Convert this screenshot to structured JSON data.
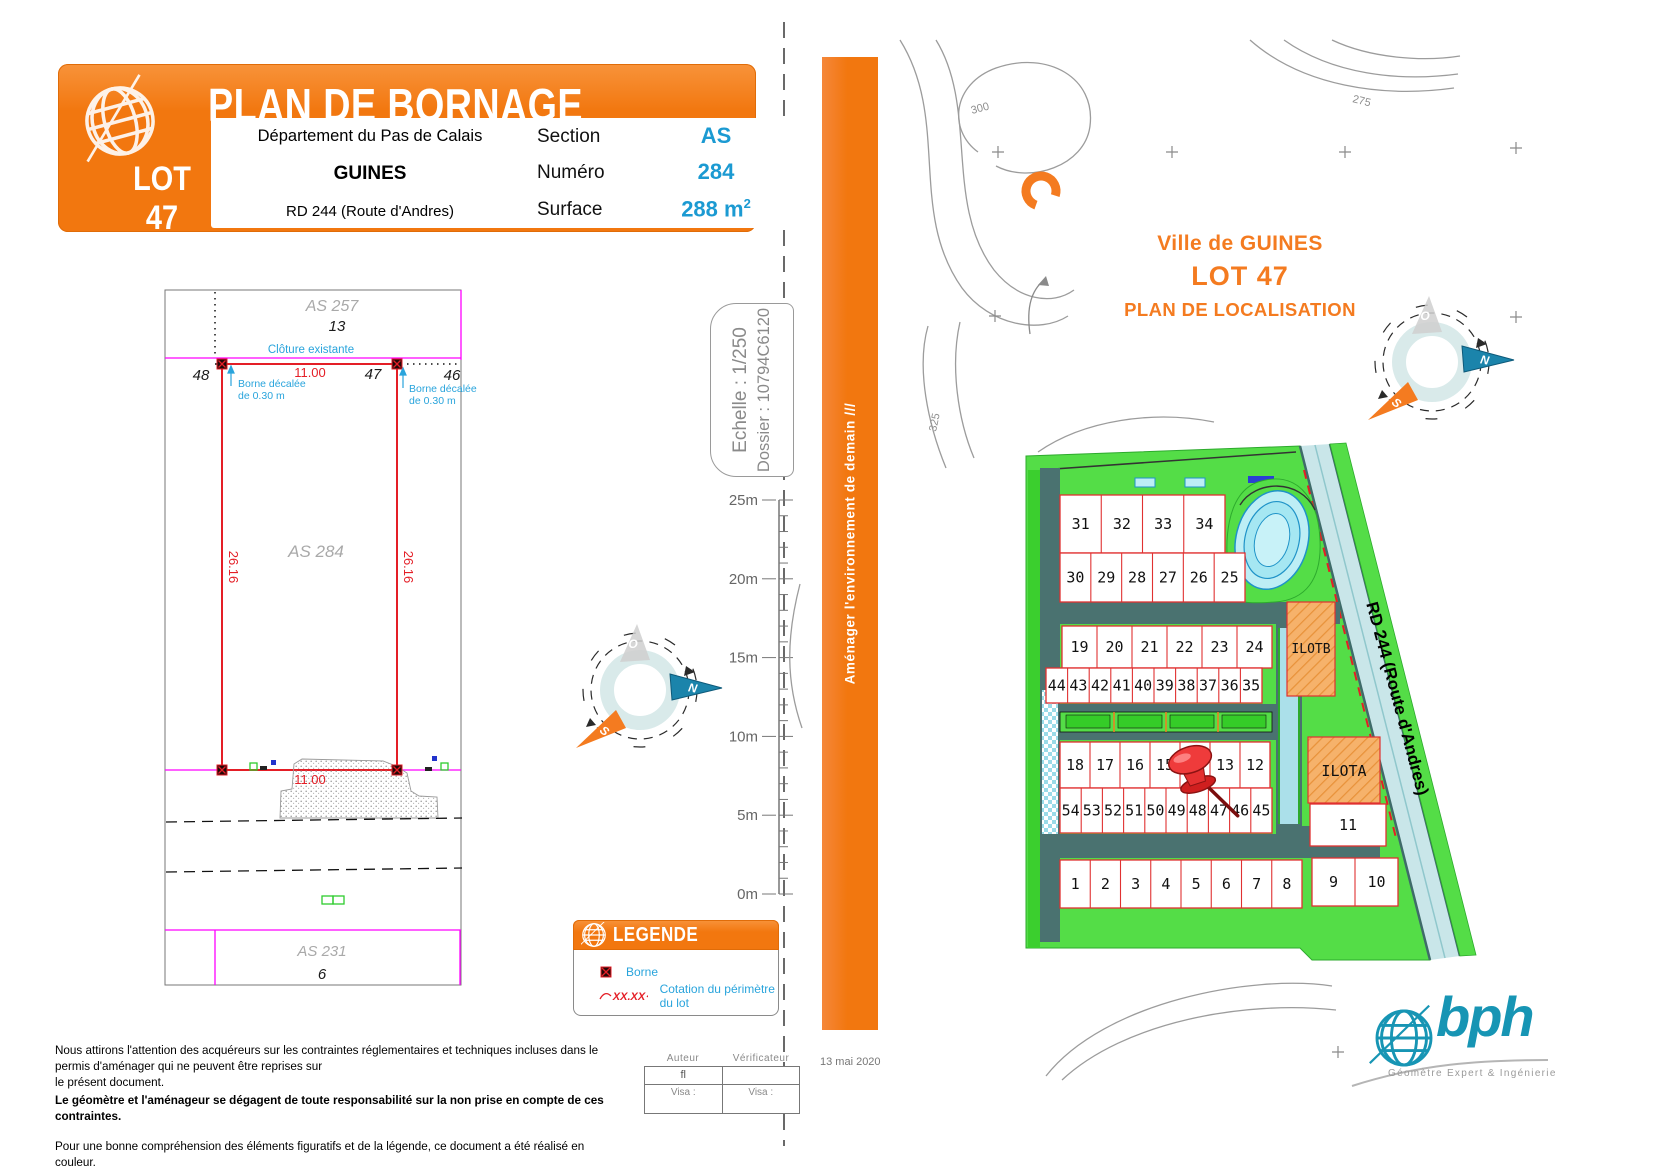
{
  "header": {
    "title": "PLAN DE BORNAGE",
    "lot": "LOT 47",
    "departement": "Département du Pas de Calais",
    "commune": "GUINES",
    "road": "RD 244 (Route d'Andres)",
    "fields": [
      {
        "label": "Section",
        "value": "AS"
      },
      {
        "label": "Numéro",
        "value": "284"
      },
      {
        "label": "Surface",
        "value": "288 m",
        "sup": "2"
      }
    ]
  },
  "survey": {
    "parcel_top": "AS 257",
    "parcel_top_num": "13",
    "cloture": "Clôture existante",
    "dim_top": "11.00",
    "pt_left": "48",
    "pt_mid": "47",
    "pt_right": "46",
    "note_l1": "Borne décalée",
    "note_l2": "de 0.30 m",
    "dim_left": "26.16",
    "dim_right": "26.16",
    "parcel_main": "AS 284",
    "dim_bottom": "11.00",
    "parcel_bottom": "AS 231",
    "parcel_bottom_num": "6"
  },
  "scalebox": {
    "echelle": "Echelle : 1/250",
    "dossier": "Dossier : 10794C6120"
  },
  "ruler": {
    "labels": [
      "25m",
      "20m",
      "15m",
      "10m",
      "5m",
      "0m"
    ]
  },
  "legend": {
    "title": "LEGENDE",
    "borne_label": "Borne",
    "cotation_sample": "XX.XX",
    "cotation_label": "Cotation du périmètre du lot"
  },
  "notes": {
    "l1": "Nous attirons l'attention des acquéreurs sur les contraintes réglementaires et techniques incluses dans le permis d'aménager qui ne peuvent être reprises sur",
    "l2": "le présent document.",
    "l3": "Le géomètre et l'aménageur se dégagent de toute responsabilité sur la non prise en compte de ces contraintes.",
    "l4": "Pour une bonne compréhension des éléments figuratifs et de la légende, ce document a été réalisé en couleur."
  },
  "approval": {
    "author_header": "Auteur",
    "verifier_header": "Vérificateur",
    "author": "fl",
    "visa_left": "Visa :",
    "visa_right": "Visa :"
  },
  "banner": {
    "slogan": "Aménager l'environnement de demain ///",
    "date": "13 mai 2020"
  },
  "loc": {
    "line1": "Ville de GUINES",
    "line2": "LOT 47",
    "line3": "PLAN DE LOCALISATION",
    "rd_label": "RD 244 (Route d'Andres)",
    "ilot_b": "ILOTB",
    "ilot_a": "ILOTA",
    "contours": [
      "300",
      "275",
      "325"
    ],
    "rows": [
      {
        "x": 1060,
        "y": 495,
        "w": 165,
        "h": 58,
        "lots": [
          "31",
          "32",
          "33",
          "34"
        ]
      },
      {
        "x": 1060,
        "y": 553,
        "w": 185,
        "h": 49,
        "lots": [
          "30",
          "29",
          "28",
          "27",
          "26",
          "25"
        ]
      },
      {
        "x": 1062,
        "y": 626,
        "w": 210,
        "h": 42,
        "lots": [
          "19",
          "20",
          "21",
          "22",
          "23",
          "24"
        ]
      },
      {
        "x": 1046,
        "y": 668,
        "w": 216,
        "h": 35,
        "lots": [
          "44",
          "43",
          "42",
          "41",
          "40",
          "39",
          "38",
          "37",
          "36",
          "35"
        ]
      },
      {
        "x": 1060,
        "y": 742,
        "w": 210,
        "h": 46,
        "lots": [
          "18",
          "17",
          "16",
          "15",
          "",
          "13",
          "12"
        ]
      },
      {
        "x": 1060,
        "y": 788,
        "w": 212,
        "h": 45,
        "lots": [
          "54",
          "53",
          "52",
          "51",
          "50",
          "49",
          "48",
          "47",
          "46",
          "45"
        ]
      },
      {
        "x": 1060,
        "y": 860,
        "w": 242,
        "h": 48,
        "lots": [
          "1",
          "2",
          "3",
          "4",
          "5",
          "6",
          "7",
          "8"
        ]
      },
      {
        "x": 1312,
        "y": 858,
        "w": 86,
        "h": 48,
        "lots": [
          "9",
          "10"
        ]
      },
      {
        "x": 1310,
        "y": 804,
        "w": 76,
        "h": 42,
        "lots": [
          "11"
        ]
      }
    ]
  },
  "logo": {
    "name": "bph",
    "tagline": "Géomètre Expert & Ingénierie"
  },
  "compass": {
    "n": "N",
    "s": "S",
    "o": "O"
  },
  "colors": {
    "accent_orange": "#F2770F",
    "value_cyan": "#1B9AD2",
    "dim_red": "#E41E26",
    "limit_magenta": "#FF00FF",
    "map_green": "#54DD47",
    "road_teal": "#4A7270",
    "brand_teal": "#1795B4"
  }
}
